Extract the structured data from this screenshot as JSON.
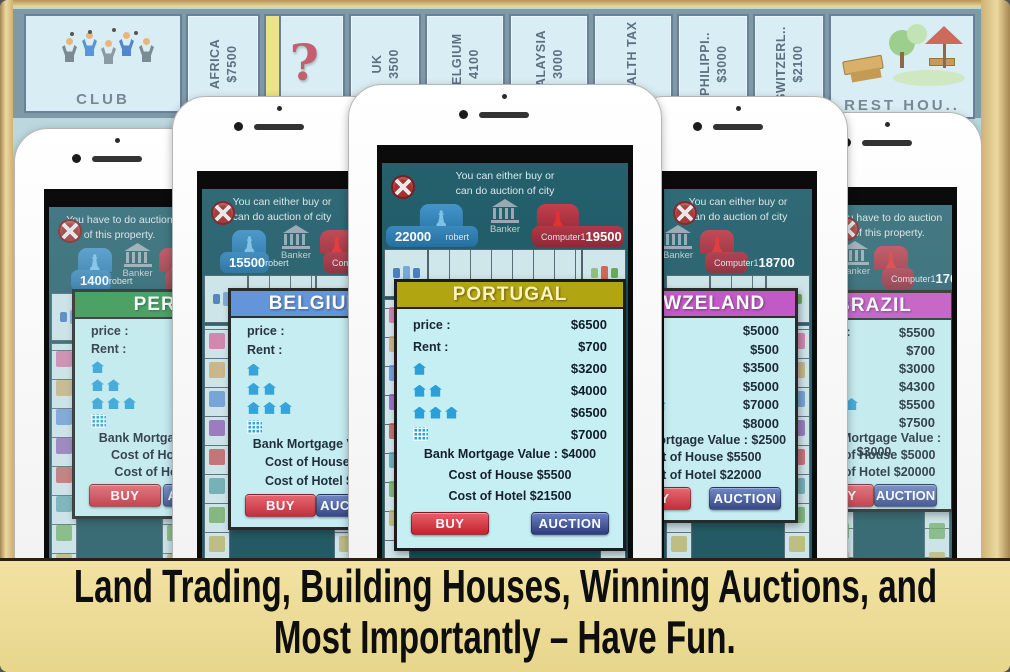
{
  "caption": {
    "line1": "Land Trading, Building Houses, Winning Auctions, and",
    "line2": "Most Importantly – Have Fun."
  },
  "board": {
    "corner_left_label": "CLUB",
    "corner_right_label": "REST HOU..",
    "tiles": [
      {
        "name": "AFRICA",
        "price": "$7500"
      },
      {
        "name": "?",
        "price": ""
      },
      {
        "name": "UK",
        "price": "3500"
      },
      {
        "name": "BELGIUM",
        "price": "4100"
      },
      {
        "name": "MALAYSIA",
        "price": "3000"
      },
      {
        "name": "WEALTH TAX",
        "price": ""
      },
      {
        "name": "PHILIPPI..",
        "price": "$3000"
      },
      {
        "name": "SWITZERL..",
        "price": "$2100"
      }
    ]
  },
  "phones": [
    {
      "message": [
        "You have to do auction",
        "of this property."
      ],
      "left_money": "1400",
      "left_name": "robert",
      "banker": "Banker",
      "right_name": "Computer1",
      "right_money": "",
      "dialog": {
        "title": "PERU",
        "color": "#2f9447",
        "title_color": "#ffffff",
        "price_label": "price :",
        "price": "",
        "rent_label": "Rent :",
        "rent": "",
        "house1": "",
        "house2": "",
        "house3": "",
        "hotel": "",
        "mortgage": "Bank Mortgage Value",
        "house_cost": "Cost of House $2",
        "hotel_cost": "Cost of Hotel $8",
        "buy": "BUY",
        "auction": "AUCTION"
      }
    },
    {
      "message": [
        "You can either buy or",
        "can do auction of city"
      ],
      "left_money": "15500",
      "left_name": "robert",
      "banker": "Banker",
      "right_name": "Computer1",
      "right_money": "",
      "dialog": {
        "title": "BELGIUM",
        "color": "#5d8fd8",
        "title_color": "#ffffff",
        "price_label": "price :",
        "price": "",
        "rent_label": "Rent :",
        "rent": "",
        "house1": "",
        "house2": "",
        "house3": "",
        "hotel": "",
        "mortgage": "Bank Mortgage Value",
        "house_cost": "Cost of House $5",
        "hotel_cost": "Cost of Hotel $20",
        "buy": "BUY",
        "auction": "AUCTION"
      }
    },
    {
      "message": [
        "You can either buy or",
        "can do auction of city"
      ],
      "left_money": "22000",
      "left_name": "robert",
      "banker": "Banker",
      "right_name": "Computer1",
      "right_money": "19500",
      "dialog": {
        "title": "PORTUGAL",
        "color": "#b2a512",
        "title_color": "#fdf3bd",
        "price_label": "price :",
        "price": "$6500",
        "rent_label": "Rent :",
        "rent": "$700",
        "house1": "$3200",
        "house2": "$4000",
        "house3": "$6500",
        "hotel": "$7000",
        "mortgage": "Bank Mortgage Value : $4000",
        "house_cost": "Cost of House $5500",
        "hotel_cost": "Cost of Hotel $21500",
        "buy": "BUY",
        "auction": "AUCTION"
      }
    },
    {
      "message": [
        "You can either buy or",
        "can do auction of city"
      ],
      "left_money": "",
      "left_name": "",
      "banker": "Banker",
      "right_name": "Computer1",
      "right_money": "18700",
      "dialog": {
        "title": "NEWZELAND",
        "color": "#c24fc4",
        "title_color": "#ffffff",
        "price_label": "price :",
        "price": "$5000",
        "rent_label": "Rent :",
        "rent": "$500",
        "house1": "$3500",
        "house2": "$5000",
        "house3": "$7000",
        "hotel": "$8000",
        "mortgage": "Bank Mortgage Value : $2500",
        "house_cost": "Cost of House $5500",
        "hotel_cost": "Cost of Hotel $22000",
        "buy": "BUY",
        "auction": "AUCTION"
      }
    },
    {
      "message": [
        "You have to do auction",
        "of this property."
      ],
      "left_money": "",
      "left_name": "",
      "banker": "Banker",
      "right_name": "Computer1",
      "right_money": "1764",
      "dialog": {
        "title": "BRAZIL",
        "color": "#c84cc0",
        "title_color": "#ffffff",
        "price_label": "price :",
        "price": "$5500",
        "rent_label": "Rent :",
        "rent": "$700",
        "house1": "$3000",
        "house2": "$4300",
        "house3": "$5500",
        "hotel": "$7500",
        "mortgage": "Bank Mortgage Value : $3000",
        "house_cost": "Cost of House $5000",
        "hotel_cost": "Cost of Hotel $20000",
        "buy": "BUY",
        "auction": "AUCTION"
      }
    }
  ]
}
